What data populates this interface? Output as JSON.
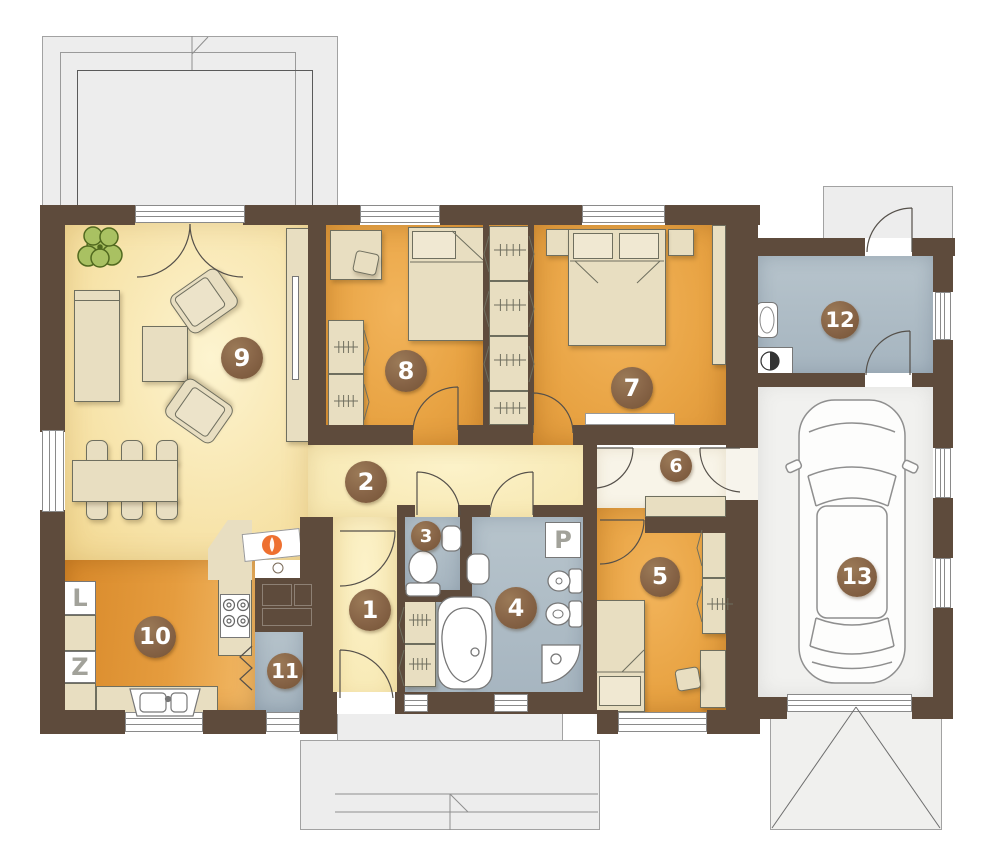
{
  "palette": {
    "wall": "#5e4b3c",
    "badge_fill": "#866346",
    "floor_cream": "#f6e1a4",
    "floor_orange": "#e8a343",
    "floor_kitchen": "#e59c3e",
    "floor_blue": "#aebcc6",
    "floor_garage": "#f1f1ef",
    "outdoor": "#ededed",
    "furniture": "#e8dec1",
    "fixture_white": "#ffffff",
    "flame": "#ee7030",
    "plant": "#a9c162"
  },
  "rooms": [
    {
      "number": "1"
    },
    {
      "number": "2"
    },
    {
      "number": "3"
    },
    {
      "number": "4"
    },
    {
      "number": "5"
    },
    {
      "number": "6"
    },
    {
      "number": "7"
    },
    {
      "number": "8"
    },
    {
      "number": "9"
    },
    {
      "number": "10"
    },
    {
      "number": "11"
    },
    {
      "number": "12"
    },
    {
      "number": "13"
    }
  ],
  "appliances": {
    "fridge_label": "L",
    "freezer_label": "Z",
    "washing_machine_label": "P"
  },
  "icons": [
    "plant-icon",
    "armchair-icon",
    "coffee-table-icon",
    "sideboard-icon",
    "tv-cabinet-icon",
    "dining-table-icon",
    "chair-icon",
    "single-bed-icon",
    "double-bed-icon",
    "nightstand-icon",
    "wardrobe-icon",
    "desk-icon",
    "toilet-icon",
    "washbasin-icon",
    "bathtub-icon",
    "shower-icon",
    "washing-machine-icon",
    "kitchen-sink-icon",
    "stove-icon",
    "fridge-icon",
    "freezer-icon",
    "fireplace-icon",
    "boiler-icon",
    "utility-sink-icon",
    "car-icon",
    "door-swing-icon",
    "window-icon"
  ]
}
